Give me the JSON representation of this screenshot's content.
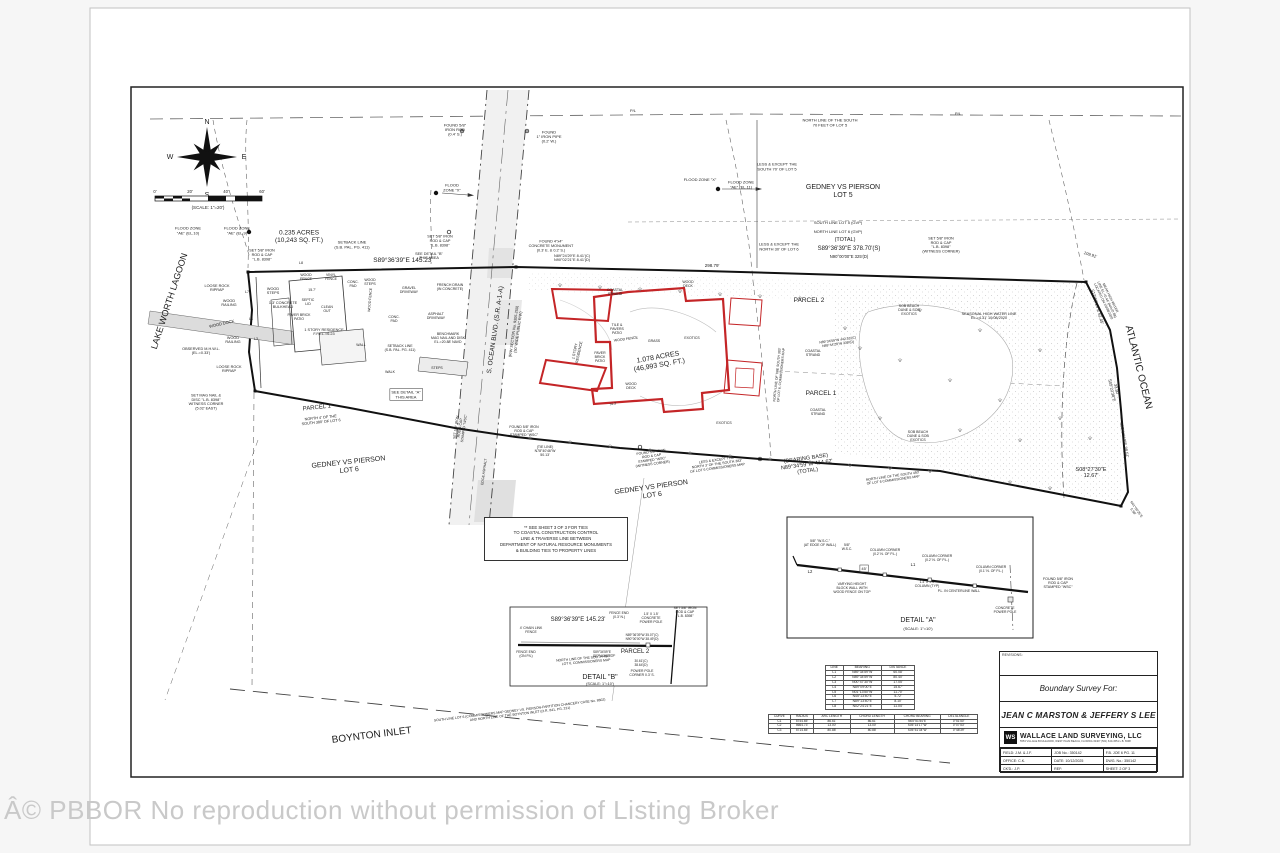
{
  "watermark": "Â© PBBOR No reproduction without permission of Listing Broker",
  "compass": {
    "n": "N",
    "e": "E",
    "s": "S",
    "w": "W"
  },
  "scale_bar": {
    "ticks": [
      "0'",
      "20'",
      "40'",
      "60'"
    ],
    "caption": "(SCALE: 1\"=20')"
  },
  "note_box": {
    "lines": [
      "** SEE SHEET 3 OF 3 FOR TIES",
      "TO COASTAL CONSTRUCTION CONTROL",
      "LINE & TRAVERSE LINE BETWEEN",
      "DEPARTMENT OF NATURAL RESOURCE MONUMENTS",
      "& BUILDING TIES TO PROPERTY LINES"
    ]
  },
  "line_table": {
    "headers": [
      "LINE",
      "BEARING",
      "DISTANCE"
    ],
    "rows": [
      [
        "L1",
        "N89°34'59\"W",
        "60.08'"
      ],
      [
        "L2",
        "N89°34'59\"W",
        "80.40'"
      ],
      [
        "L3",
        "N00°47'30\"W",
        "17.05'"
      ],
      [
        "L4",
        "N89°09'00\"E",
        "15.67'"
      ],
      [
        "L5",
        "N01°13'50\"W",
        "11.70'"
      ],
      [
        "L6",
        "N45°13'40\"E",
        "5.72'"
      ],
      [
        "L7",
        "N89°13'40\"E",
        "8.10'"
      ],
      [
        "L8",
        "N02°24'21\"E",
        "11.04'"
      ]
    ]
  },
  "curve_table": {
    "headers": [
      "CURVE",
      "RADIUS",
      "ARC LENGTH",
      "CHORD LENGTH",
      "CHORD BEARING",
      "DELTA ANGLE"
    ],
    "rows": [
      [
        "C1",
        "5744.65'",
        "86.61'",
        "86.61'",
        "N05°51'54\"E",
        "0°51'50\""
      ],
      [
        "C2",
        "5664.73'",
        "13.00'",
        "13.00'",
        "S05°14'17\"W",
        "0°07'53\""
      ],
      [
        "C3",
        "5714.65'",
        "80.88'",
        "80.88'",
        "S05°51'34\"W",
        "0°48'39\""
      ]
    ]
  },
  "title_block": {
    "revisions_label": "REVISIONS:",
    "survey_for_label": "Boundary Survey For:",
    "client": "JEAN C MARSTON & JEFFERY S LEE",
    "logo_initials": "WS",
    "company": "WALLACE LAND SURVEYING, LLC",
    "company_sub": "5553 VILLAGE BOULEVARD, WEST PALM BEACH, FLORIDA 33407  (561) 640-4551  L.B. 8398",
    "fields": [
      [
        "FIELD: J.M. & J.F.",
        "JOB No.: 350142",
        "F.B. JOE 6  PG. 11"
      ],
      [
        "OFFICE: C.K.",
        "DATE: 10/12/2025",
        "DWG. No.: 350142"
      ],
      [
        "CK'D.: J.P.",
        "REF:",
        "SHEET: 2 OF 3"
      ]
    ]
  },
  "labels": [
    {
      "t": "P/L",
      "x": 633,
      "y": 112,
      "s": 4
    },
    {
      "t": "P/L",
      "x": 958,
      "y": 115,
      "s": 4
    },
    {
      "t": "NORTH LINE OF THE SOUTH\n70 FEET OF LOT 5",
      "x": 830,
      "y": 124,
      "s": 4
    },
    {
      "t": "FOUND 5/8\"\nIRON ROD\n(0.4' S.)",
      "x": 455,
      "y": 131,
      "s": 4
    },
    {
      "t": "FOUND\n1\" IRON PIPE\n(0.2' W.)",
      "x": 549,
      "y": 138,
      "s": 4
    },
    {
      "t": "LESS & EXCEPT THE\nSOUTH 70' OF LOT 5",
      "x": 777,
      "y": 168,
      "s": 4
    },
    {
      "t": "GEDNEY VS PIERSON\nLOT 5",
      "x": 843,
      "y": 193,
      "s": 7
    },
    {
      "t": "FLOOD ZONE \"X\"",
      "x": 700,
      "y": 181,
      "s": 4
    },
    {
      "t": "FLOOD ZONE\n\"AE\" (EL.11)",
      "x": 741,
      "y": 186,
      "s": 4
    },
    {
      "t": "FLOOD\nZONE \"X\"",
      "x": 452,
      "y": 189,
      "s": 4
    },
    {
      "t": "SOUTH LINE LOT 5 (GVP)",
      "x": 838,
      "y": 224,
      "s": 4
    },
    {
      "t": "NORTH LINE LOT 6 (GVP)",
      "x": 838,
      "y": 233,
      "s": 4
    },
    {
      "t": "LESS & EXCEPT THE\nNORTH 30' OF LOT 6",
      "x": 779,
      "y": 248,
      "s": 4
    },
    {
      "t": "(TOTAL)",
      "x": 845,
      "y": 241,
      "s": 5.5
    },
    {
      "t": "S89°36'39\"E    378.70'(S)",
      "x": 849,
      "y": 250,
      "s": 6
    },
    {
      "t": "N90°00'00\"E    325'(D)",
      "x": 849,
      "y": 258,
      "s": 4.2
    },
    {
      "t": "SET 5/8\" IRON\nROD & CAP\n\"L.B. 8398\"\n(WITNESS CORNER)",
      "x": 941,
      "y": 246,
      "s": 3.8
    },
    {
      "t": "298.79'",
      "x": 712,
      "y": 267,
      "s": 4.5
    },
    {
      "t": "109.91'",
      "x": 1090,
      "y": 256,
      "r": 18,
      "s": 4.2
    },
    {
      "t": "FLOOD ZONE\n\"AE\" (EL.10)",
      "x": 188,
      "y": 232,
      "s": 4
    },
    {
      "t": "FLOOD ZONE\n\"AE\" (EL.9)",
      "x": 237,
      "y": 232,
      "s": 4
    },
    {
      "t": "0.235 ACRES\n(10,243 SQ. FT.)",
      "x": 299,
      "y": 238,
      "s": 6.5
    },
    {
      "t": "SET 5/8\" IRON\nROD & CAP\n\"L.B. 8398\"",
      "x": 262,
      "y": 256,
      "s": 3.8
    },
    {
      "t": "SETBACK LINE\n(S.B. PAL. PG. 411)",
      "x": 352,
      "y": 246,
      "s": 4
    },
    {
      "t": "S89°36'39\"E   145.23'",
      "x": 403,
      "y": 262,
      "s": 6.5
    },
    {
      "t": "LAKE WORTH LAGOON",
      "x": 172,
      "y": 302,
      "r": -72,
      "s": 9
    },
    {
      "t": "LOOSE ROCK\nRIPRAP",
      "x": 217,
      "y": 289,
      "s": 3.8
    },
    {
      "t": "WOOD\nSTEPS",
      "x": 273,
      "y": 292,
      "s": 3.8
    },
    {
      "t": "1.3' CONCRETE\nBULKHEAD",
      "x": 283,
      "y": 306,
      "s": 3.8
    },
    {
      "t": "WOOD\nRAILING",
      "x": 229,
      "y": 304,
      "s": 3.8
    },
    {
      "t": "WOOD DOCK",
      "x": 222,
      "y": 325,
      "r": -13,
      "s": 4
    },
    {
      "t": "WOOD\nRAILING",
      "x": 233,
      "y": 341,
      "s": 3.8
    },
    {
      "t": "OBSERVED M.H.W.L.\n(EL.=0.33')",
      "x": 201,
      "y": 352,
      "s": 3.8
    },
    {
      "t": "LOOSE ROCK\nRIPRAP",
      "x": 229,
      "y": 370,
      "s": 3.8
    },
    {
      "t": "SET MAG NAIL &\nDISC \"L.B. 8398\"\nWITNESS CORNER\n(5.02' EAST)",
      "x": 206,
      "y": 403,
      "s": 3.8
    },
    {
      "t": "L8",
      "x": 301,
      "y": 264,
      "s": 3.6
    },
    {
      "t": "L7",
      "x": 247,
      "y": 293,
      "s": 3.6
    },
    {
      "t": "L4",
      "x": 251,
      "y": 320,
      "s": 3.6
    },
    {
      "t": "L3",
      "x": 256,
      "y": 340,
      "s": 3.6
    },
    {
      "t": "PARCEL 1",
      "x": 317,
      "y": 409,
      "r": -6,
      "s": 6
    },
    {
      "t": "NORTH 4' OF THE\nSOUTH 380' OF LOT 6",
      "x": 321,
      "y": 421,
      "r": -6,
      "s": 3.8
    },
    {
      "t": "GEDNEY VS PIERSON\nLOT 6",
      "x": 349,
      "y": 468,
      "r": -6,
      "s": 7
    },
    {
      "t": "WOOD\nFENCE",
      "x": 306,
      "y": 278,
      "s": 3.5
    },
    {
      "t": "VINYL\nFENCE",
      "x": 331,
      "y": 278,
      "s": 3.5
    },
    {
      "t": "CONC.\nPAD",
      "x": 353,
      "y": 285,
      "s": 3.5
    },
    {
      "t": "15.7'",
      "x": 312,
      "y": 291,
      "s": 3.5
    },
    {
      "t": "SEPTIC\nLID",
      "x": 308,
      "y": 303,
      "s": 3.5
    },
    {
      "t": "CLEAN\nOUT",
      "x": 327,
      "y": 310,
      "s": 3.5
    },
    {
      "t": "PAVER BRICK\nPATIO",
      "x": 299,
      "y": 318,
      "s": 3.5
    },
    {
      "t": "1 STORY RESIDENCE\nF.F.EL.=6.23",
      "x": 324,
      "y": 333,
      "s": 3.8
    },
    {
      "t": "WOOD FENCE",
      "x": 371,
      "y": 300,
      "r": -85,
      "s": 3.5
    },
    {
      "t": "WOOD\nSTEPS",
      "x": 370,
      "y": 283,
      "s": 3.5
    },
    {
      "t": "WALL",
      "x": 361,
      "y": 346,
      "s": 3.5
    },
    {
      "t": "GRAVEL\nDRIVEWAY",
      "x": 409,
      "y": 291,
      "s": 3.5
    },
    {
      "t": "FRENCH DRAIN\n(IN CONCRETE)",
      "x": 450,
      "y": 288,
      "s": 3.5
    },
    {
      "t": "ASPHALT\nDRIVEWAY",
      "x": 436,
      "y": 317,
      "s": 3.5
    },
    {
      "t": "CONC.\nPAD",
      "x": 394,
      "y": 320,
      "s": 3.5
    },
    {
      "t": "BENCHMARK\nMAG NAIL AND DISK\nEL.=20.88' NAVD",
      "x": 448,
      "y": 339,
      "s": 3.5
    },
    {
      "t": "SETBACK LINE\n(S.B. PAL. PG. 411)",
      "x": 400,
      "y": 349,
      "s": 3.5
    },
    {
      "t": "STEPS",
      "x": 437,
      "y": 369,
      "s": 3.5
    },
    {
      "t": "WALK",
      "x": 390,
      "y": 373,
      "s": 3.5
    },
    {
      "t": "SEE DETAIL \"A\"\nTHIS AREA",
      "x": 406,
      "y": 396,
      "s": 4,
      "box": true
    },
    {
      "t": "SEE DETAIL \"B\"\nTHIS AREA",
      "x": 429,
      "y": 257,
      "s": 3.8
    },
    {
      "t": "SET 5/8\" IRON\nROD & CAP\n\"L.B. 8398\"",
      "x": 440,
      "y": 242,
      "s": 3.8
    },
    {
      "t": "FOUND 4\"x4\"\nCONCRETE MONUMENT\n(0.3' E. & 0.2' S.)",
      "x": 551,
      "y": 247,
      "s": 3.8
    },
    {
      "t": "N89°24'29\"E 8.41'(C)\nN90°02'21\"E 8.41'(D)",
      "x": 572,
      "y": 259,
      "s": 3.8
    },
    {
      "t": "S. OCEAN BLVD. (S.R. A-1-A)",
      "x": 497,
      "y": 330,
      "r": -82,
      "s": 6.5
    },
    {
      "t": "(R/W SECTION No. 9305-250)\n(50' WIDE PUBLIC R/W)",
      "x": 517,
      "y": 332,
      "r": -82,
      "s": 3.8
    },
    {
      "t": "SET 5/8\" IRON\nROD & CAP\nSTAMPED \"WSC\"",
      "x": 461,
      "y": 428,
      "r": -82,
      "s": 3.5
    },
    {
      "t": "EDGE ASPHALT",
      "x": 485,
      "y": 472,
      "r": -82,
      "s": 3.5
    },
    {
      "t": "FOUND 5/8\" IRON\nROD & CAP\nSTAMPED \"WSC\"",
      "x": 524,
      "y": 432,
      "s": 3.5
    },
    {
      "t": "(TIE LINE)\nN78°40'46\"W\n50.13'",
      "x": 545,
      "y": 452,
      "s": 3.5
    },
    {
      "t": "COASTAL\nSTRAND",
      "x": 615,
      "y": 293,
      "s": 3.5
    },
    {
      "t": "WOOD\nDECK",
      "x": 688,
      "y": 285,
      "s": 3.5
    },
    {
      "t": "TILE &\nPAVERS\nPATIO",
      "x": 617,
      "y": 330,
      "s": 3.5
    },
    {
      "t": "WOOD FENCE",
      "x": 626,
      "y": 340,
      "r": -8,
      "s": 3.5
    },
    {
      "t": "GRASS",
      "x": 654,
      "y": 342,
      "s": 3.5
    },
    {
      "t": "EXOTICS",
      "x": 692,
      "y": 339,
      "s": 3.5
    },
    {
      "t": "1 STORY\nRESIDENCE",
      "x": 578,
      "y": 352,
      "r": -78,
      "s": 3.8
    },
    {
      "t": "PAVER\nBRICK\nPATIO",
      "x": 600,
      "y": 358,
      "s": 3.5
    },
    {
      "t": "1.078 ACRES\n(46,993 SQ. FT.)",
      "x": 659,
      "y": 363,
      "r": -10,
      "s": 7
    },
    {
      "t": "WOOD\nDECK",
      "x": 631,
      "y": 387,
      "s": 3.5
    },
    {
      "t": "EXOTICS",
      "x": 724,
      "y": 424,
      "s": 3.5
    },
    {
      "t": "74.3'",
      "x": 613,
      "y": 405,
      "r": -10,
      "s": 3.5
    },
    {
      "t": "PARCEL 2",
      "x": 809,
      "y": 302,
      "s": 6.5
    },
    {
      "t": "PARCEL 1",
      "x": 821,
      "y": 395,
      "s": 6.5
    },
    {
      "t": "COASTAL\nSTRAND",
      "x": 813,
      "y": 354,
      "s": 3.5
    },
    {
      "t": "COASTAL\nSTRAND",
      "x": 818,
      "y": 413,
      "s": 3.5
    },
    {
      "t": "SOB BEACH\nDUNE & SOB\nEXOTICS",
      "x": 909,
      "y": 311,
      "s": 3.5
    },
    {
      "t": "SOB BEACH\nDUNE & SOB\nEXOTICS",
      "x": 918,
      "y": 437,
      "s": 3.5
    },
    {
      "t": "N89°34'59\"W  442.53'(C)\nN89°44'28\"W  339'(D)",
      "x": 838,
      "y": 343,
      "r": -8,
      "s": 3.4
    },
    {
      "t": "SEASONAL HIGH WATER LINE\nEL.=4.31' 10/08/2020",
      "x": 989,
      "y": 317,
      "s": 3.8
    },
    {
      "t": "MEAN HIGH WATER\nLINE EL.=0.44' (NAVD 88)\nLOCATED ON 10/08/2020",
      "x": 1106,
      "y": 300,
      "r": 64,
      "s": 3.4
    },
    {
      "t": "S12°50'14\"E  62.45'",
      "x": 1096,
      "y": 307,
      "r": 74,
      "s": 4.2
    },
    {
      "t": "33.80'\nS05°22'38\"E",
      "x": 1113,
      "y": 390,
      "r": 78,
      "s": 4
    },
    {
      "t": "S05°19'10\"E  38.51'",
      "x": 1123,
      "y": 440,
      "r": 80,
      "s": 4.2
    },
    {
      "t": "S08°27'30\"E\n12.67'",
      "x": 1091,
      "y": 474,
      "s": 5.5
    },
    {
      "t": "ATLANTIC OCEAN",
      "x": 1136,
      "y": 368,
      "r": 76,
      "s": 10
    },
    {
      "t": "N41°05'25\"E\n5.98'",
      "x": 1134,
      "y": 511,
      "r": 55,
      "s": 3.4
    },
    {
      "t": "NORTH LINE OF THE SOUTH 383'\nOF LOT 6, COMMISSIONERS MAP",
      "x": 780,
      "y": 375,
      "r": -84,
      "s": 3.4
    },
    {
      "t": "FOUND 5/8\" IRON\nROD & CAP\nSTAMPED \"WSC\"\n(WITNESS CORNER)",
      "x": 652,
      "y": 459,
      "r": -8,
      "s": 3.5
    },
    {
      "t": "LESS & EXCEPT THE\nNORTH 3' OF THE SOUTH 383'\nOF LOT 6 COMMISSIONERS MAP",
      "x": 717,
      "y": 465,
      "r": -8,
      "s": 3.5
    },
    {
      "t": "(BEARING BASE)\nN89°34'59\"W   414.62'\n(TOTAL)",
      "x": 807,
      "y": 466,
      "r": -8,
      "s": 5.5
    },
    {
      "t": "NORTH LINE OF THE SOUTH 450'\nOF LOT 6 COMMISSIONERS MAP",
      "x": 893,
      "y": 479,
      "r": -8,
      "s": 3.4
    },
    {
      "t": "GEDNEY VS PIERSON\nLOT 6",
      "x": 652,
      "y": 493,
      "r": -8,
      "s": 7
    },
    {
      "t": "SOUTH LINE LOT 6 (COMMISSIONERS MAP GEDNEY VS. PIERSON-PARTITION CHANCERY CASE No. 8802)\nAND NORTH LINE OF THE BOYNTON INLET (O.R. 841, PG. 231)",
      "x": 520,
      "y": 713,
      "r": -7,
      "s": 3.4
    },
    {
      "t": "BOYNTON INLET",
      "x": 372,
      "y": 738,
      "r": -7,
      "s": 10
    },
    {
      "t": "5/8\" \"W.S.C.\"\n(AT EDGE OF WALL)",
      "x": 820,
      "y": 544,
      "s": 3.4
    },
    {
      "t": "5/8\"\nW.S.C.",
      "x": 847,
      "y": 548,
      "s": 3.4
    },
    {
      "t": "COLUMN CORNER\n(0.2' N. OF P.L.)",
      "x": 885,
      "y": 553,
      "s": 3.4
    },
    {
      "t": "COLUMN CORNER\n(0.2' N. OF P.L.)",
      "x": 937,
      "y": 559,
      "s": 3.4
    },
    {
      "t": "COLUMN CORNER\n(0.1' N. OF P.L.)",
      "x": 991,
      "y": 570,
      "s": 3.4
    },
    {
      "t": "L2",
      "x": 810,
      "y": 573,
      "s": 4.2
    },
    {
      "t": "45'",
      "x": 864,
      "y": 570,
      "s": 4,
      "box": true
    },
    {
      "t": "L1",
      "x": 913,
      "y": 566,
      "s": 4.2
    },
    {
      "t": "VARYING HEIGHT\nBLOCK WALL WITH\nWOOD FENCE ON TOP",
      "x": 852,
      "y": 589,
      "s": 3.4
    },
    {
      "t": "1.4' X 1.4'\nCOLUMN (TYP)",
      "x": 927,
      "y": 585,
      "s": 3.4
    },
    {
      "t": "P.L. IN CENTERLINE WALL",
      "x": 959,
      "y": 592,
      "s": 3.4
    },
    {
      "t": "CONCRETE\nPOWER POLE",
      "x": 1005,
      "y": 611,
      "s": 3.4
    },
    {
      "t": "DETAIL \"A\"",
      "x": 918,
      "y": 622,
      "s": 7
    },
    {
      "t": "(SCALE: 1\"=10')",
      "x": 918,
      "y": 630,
      "s": 4
    },
    {
      "t": "FOUND 5/8\" IRON\nROD & CAP\nSTAMPED \"WSC\"",
      "x": 1058,
      "y": 584,
      "s": 3.6
    },
    {
      "t": "S89°36'39\"E    145.23'",
      "x": 578,
      "y": 621,
      "s": 6
    },
    {
      "t": "4' CHAIN LINK\nFENCE",
      "x": 531,
      "y": 631,
      "s": 3.4
    },
    {
      "t": "FENCE END\n(0.3' N.)",
      "x": 619,
      "y": 616,
      "s": 3.4
    },
    {
      "t": "1.5' X 1.5'\nCONCRETE\nPOWER POLE",
      "x": 651,
      "y": 619,
      "s": 3.4
    },
    {
      "t": "SET 5/8\" IRON\nROD & CAP\n\"L.B. 8398\"",
      "x": 685,
      "y": 613,
      "s": 3.4
    },
    {
      "t": "N89°36'39\"W  35.07'(C)\nN90°00'00\"W  38.49'(D)",
      "x": 642,
      "y": 638,
      "s": 3.2
    },
    {
      "t": "FENCE END\n(ON P/L)",
      "x": 526,
      "y": 655,
      "s": 3.4
    },
    {
      "t": "NORTH LINE OF THE SOUTH 450' OF\nLOT 6, COMMISSIONERS MAP",
      "x": 586,
      "y": 661,
      "r": -5,
      "s": 3.4
    },
    {
      "t": "PARCEL 2",
      "x": 635,
      "y": 653,
      "s": 6
    },
    {
      "t": "S89°34'59\"E\nS87°44'56\"E",
      "x": 602,
      "y": 655,
      "s": 3.2
    },
    {
      "t": "30.61'(C)\n38.64'(D)",
      "x": 641,
      "y": 664,
      "s": 3.2
    },
    {
      "t": "POWER POLE\nCORNER 0.3' S.",
      "x": 642,
      "y": 674,
      "s": 3.4
    },
    {
      "t": "DETAIL \"B\"",
      "x": 600,
      "y": 679,
      "s": 7
    },
    {
      "t": "(SCALE: 1\"=10')",
      "x": 600,
      "y": 685,
      "s": 3.8
    }
  ]
}
